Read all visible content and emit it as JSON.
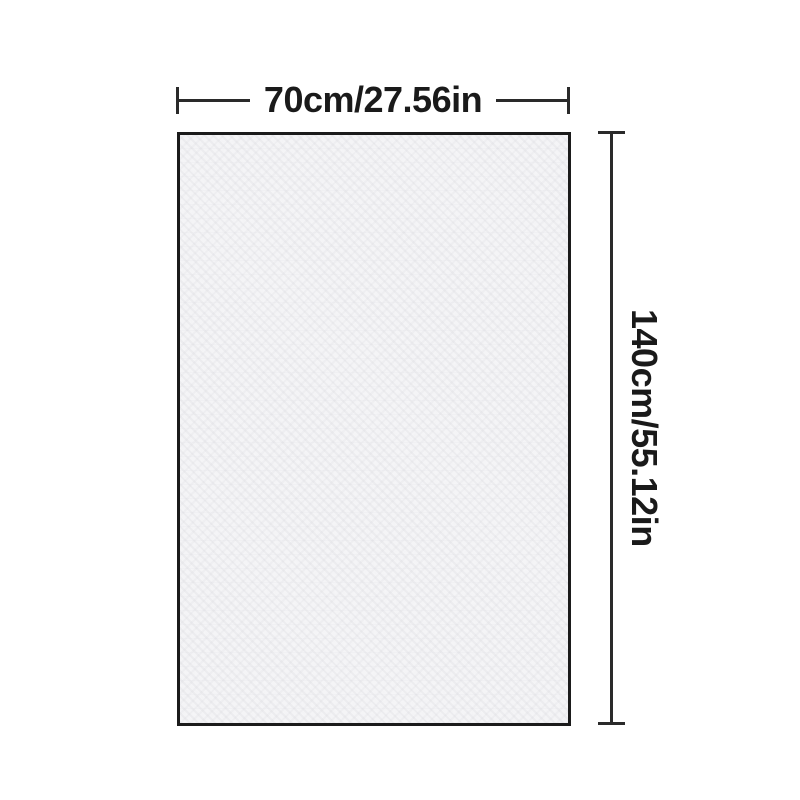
{
  "diagram": {
    "type": "product-dimension-diagram",
    "width_label": "70cm/27.56in",
    "height_label": "140cm/55.12in"
  },
  "colors": {
    "background": "#ffffff",
    "line": "#2a2a2a",
    "text": "#1a1a1a",
    "fabric_fill": "#f6f6f8",
    "fabric_border": "#1b1b1b"
  }
}
